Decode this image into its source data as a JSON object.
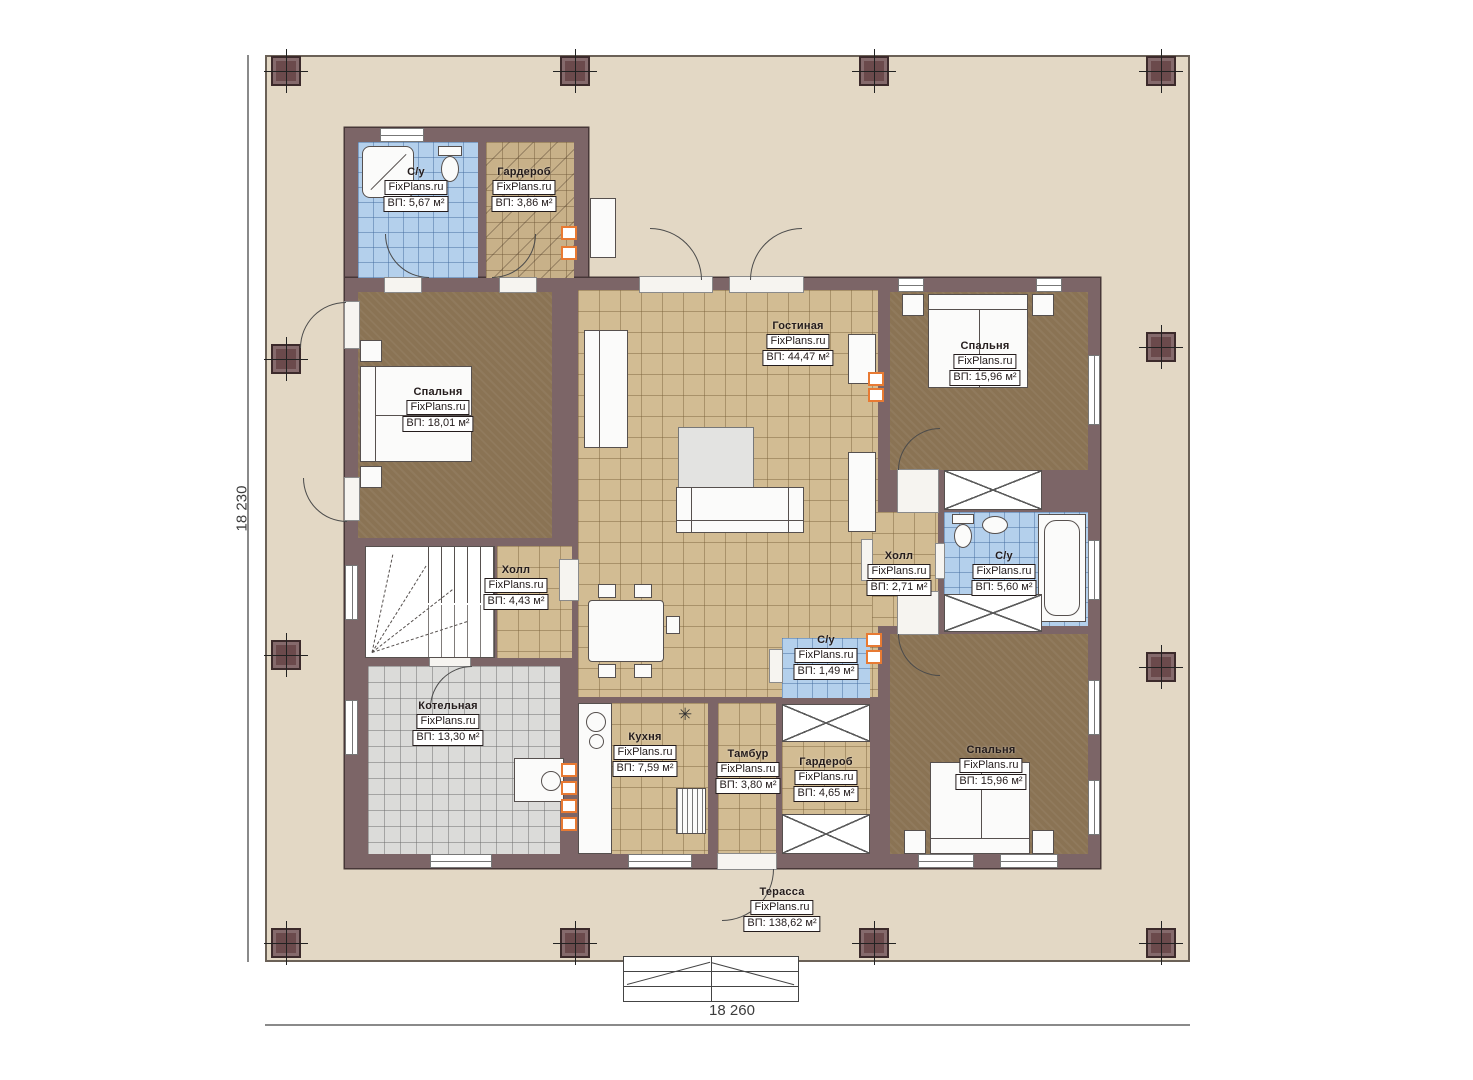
{
  "plan": {
    "title": "floor-plan",
    "watermark": "FixPlans.ru",
    "dimensions": {
      "left": "18 230",
      "bottom": "18 260"
    },
    "colors": {
      "terrace_floor": "#e3d8c5",
      "wall": "#7c6567",
      "tile_floor": "#d2bc93",
      "bathroom_tile": "#b4d0ec",
      "boiler_tile": "#dbdbd9",
      "bedroom_floor": "#8a7354",
      "wardrobe_floor": "#c8b189",
      "vent_accent": "#e87a33",
      "label_border": "#241c1c"
    },
    "symbols": {
      "kitchen_star": "✳"
    }
  },
  "rooms": [
    {
      "id": "bathroom-top",
      "name": "С/у",
      "watermark": "FixPlans.ru",
      "area": "ВП: 5,67 м²"
    },
    {
      "id": "wardrobe-top",
      "name": "Гардероб",
      "watermark": "FixPlans.ru",
      "area": "ВП: 3,86 м²"
    },
    {
      "id": "bedroom-left",
      "name": "Спальня",
      "watermark": "FixPlans.ru",
      "area": "ВП: 18,01 м²"
    },
    {
      "id": "living-room",
      "name": "Гостиная",
      "watermark": "FixPlans.ru",
      "area": "ВП: 44,47 м²"
    },
    {
      "id": "bedroom-top-right",
      "name": "Спальня",
      "watermark": "FixPlans.ru",
      "area": "ВП: 15,96 м²"
    },
    {
      "id": "hall-small",
      "name": "Холл",
      "watermark": "FixPlans.ru",
      "area": "ВП: 2,71 м²"
    },
    {
      "id": "bathroom-right",
      "name": "С/у",
      "watermark": "FixPlans.ru",
      "area": "ВП: 5,60 м²"
    },
    {
      "id": "hall-stairs",
      "name": "Холл",
      "watermark": "FixPlans.ru",
      "area": "ВП: 4,43 м²"
    },
    {
      "id": "wc-small",
      "name": "С/у",
      "watermark": "FixPlans.ru",
      "area": "ВП: 1,49 м²"
    },
    {
      "id": "boiler-room",
      "name": "Котельная",
      "watermark": "FixPlans.ru",
      "area": "ВП: 13,30 м²"
    },
    {
      "id": "kitchen",
      "name": "Кухня",
      "watermark": "FixPlans.ru",
      "area": "ВП: 7,59 м²"
    },
    {
      "id": "vestibule",
      "name": "Тамбур",
      "watermark": "FixPlans.ru",
      "area": "ВП: 3,80 м²"
    },
    {
      "id": "wardrobe-bottom",
      "name": "Гардероб",
      "watermark": "FixPlans.ru",
      "area": "ВП: 4,65 м²"
    },
    {
      "id": "bedroom-bottom-right",
      "name": "Спальня",
      "watermark": "FixPlans.ru",
      "area": "ВП: 15,96 м²"
    },
    {
      "id": "terrace",
      "name": "Терасса",
      "watermark": "FixPlans.ru",
      "area": "ВП: 138,62 м²"
    }
  ]
}
